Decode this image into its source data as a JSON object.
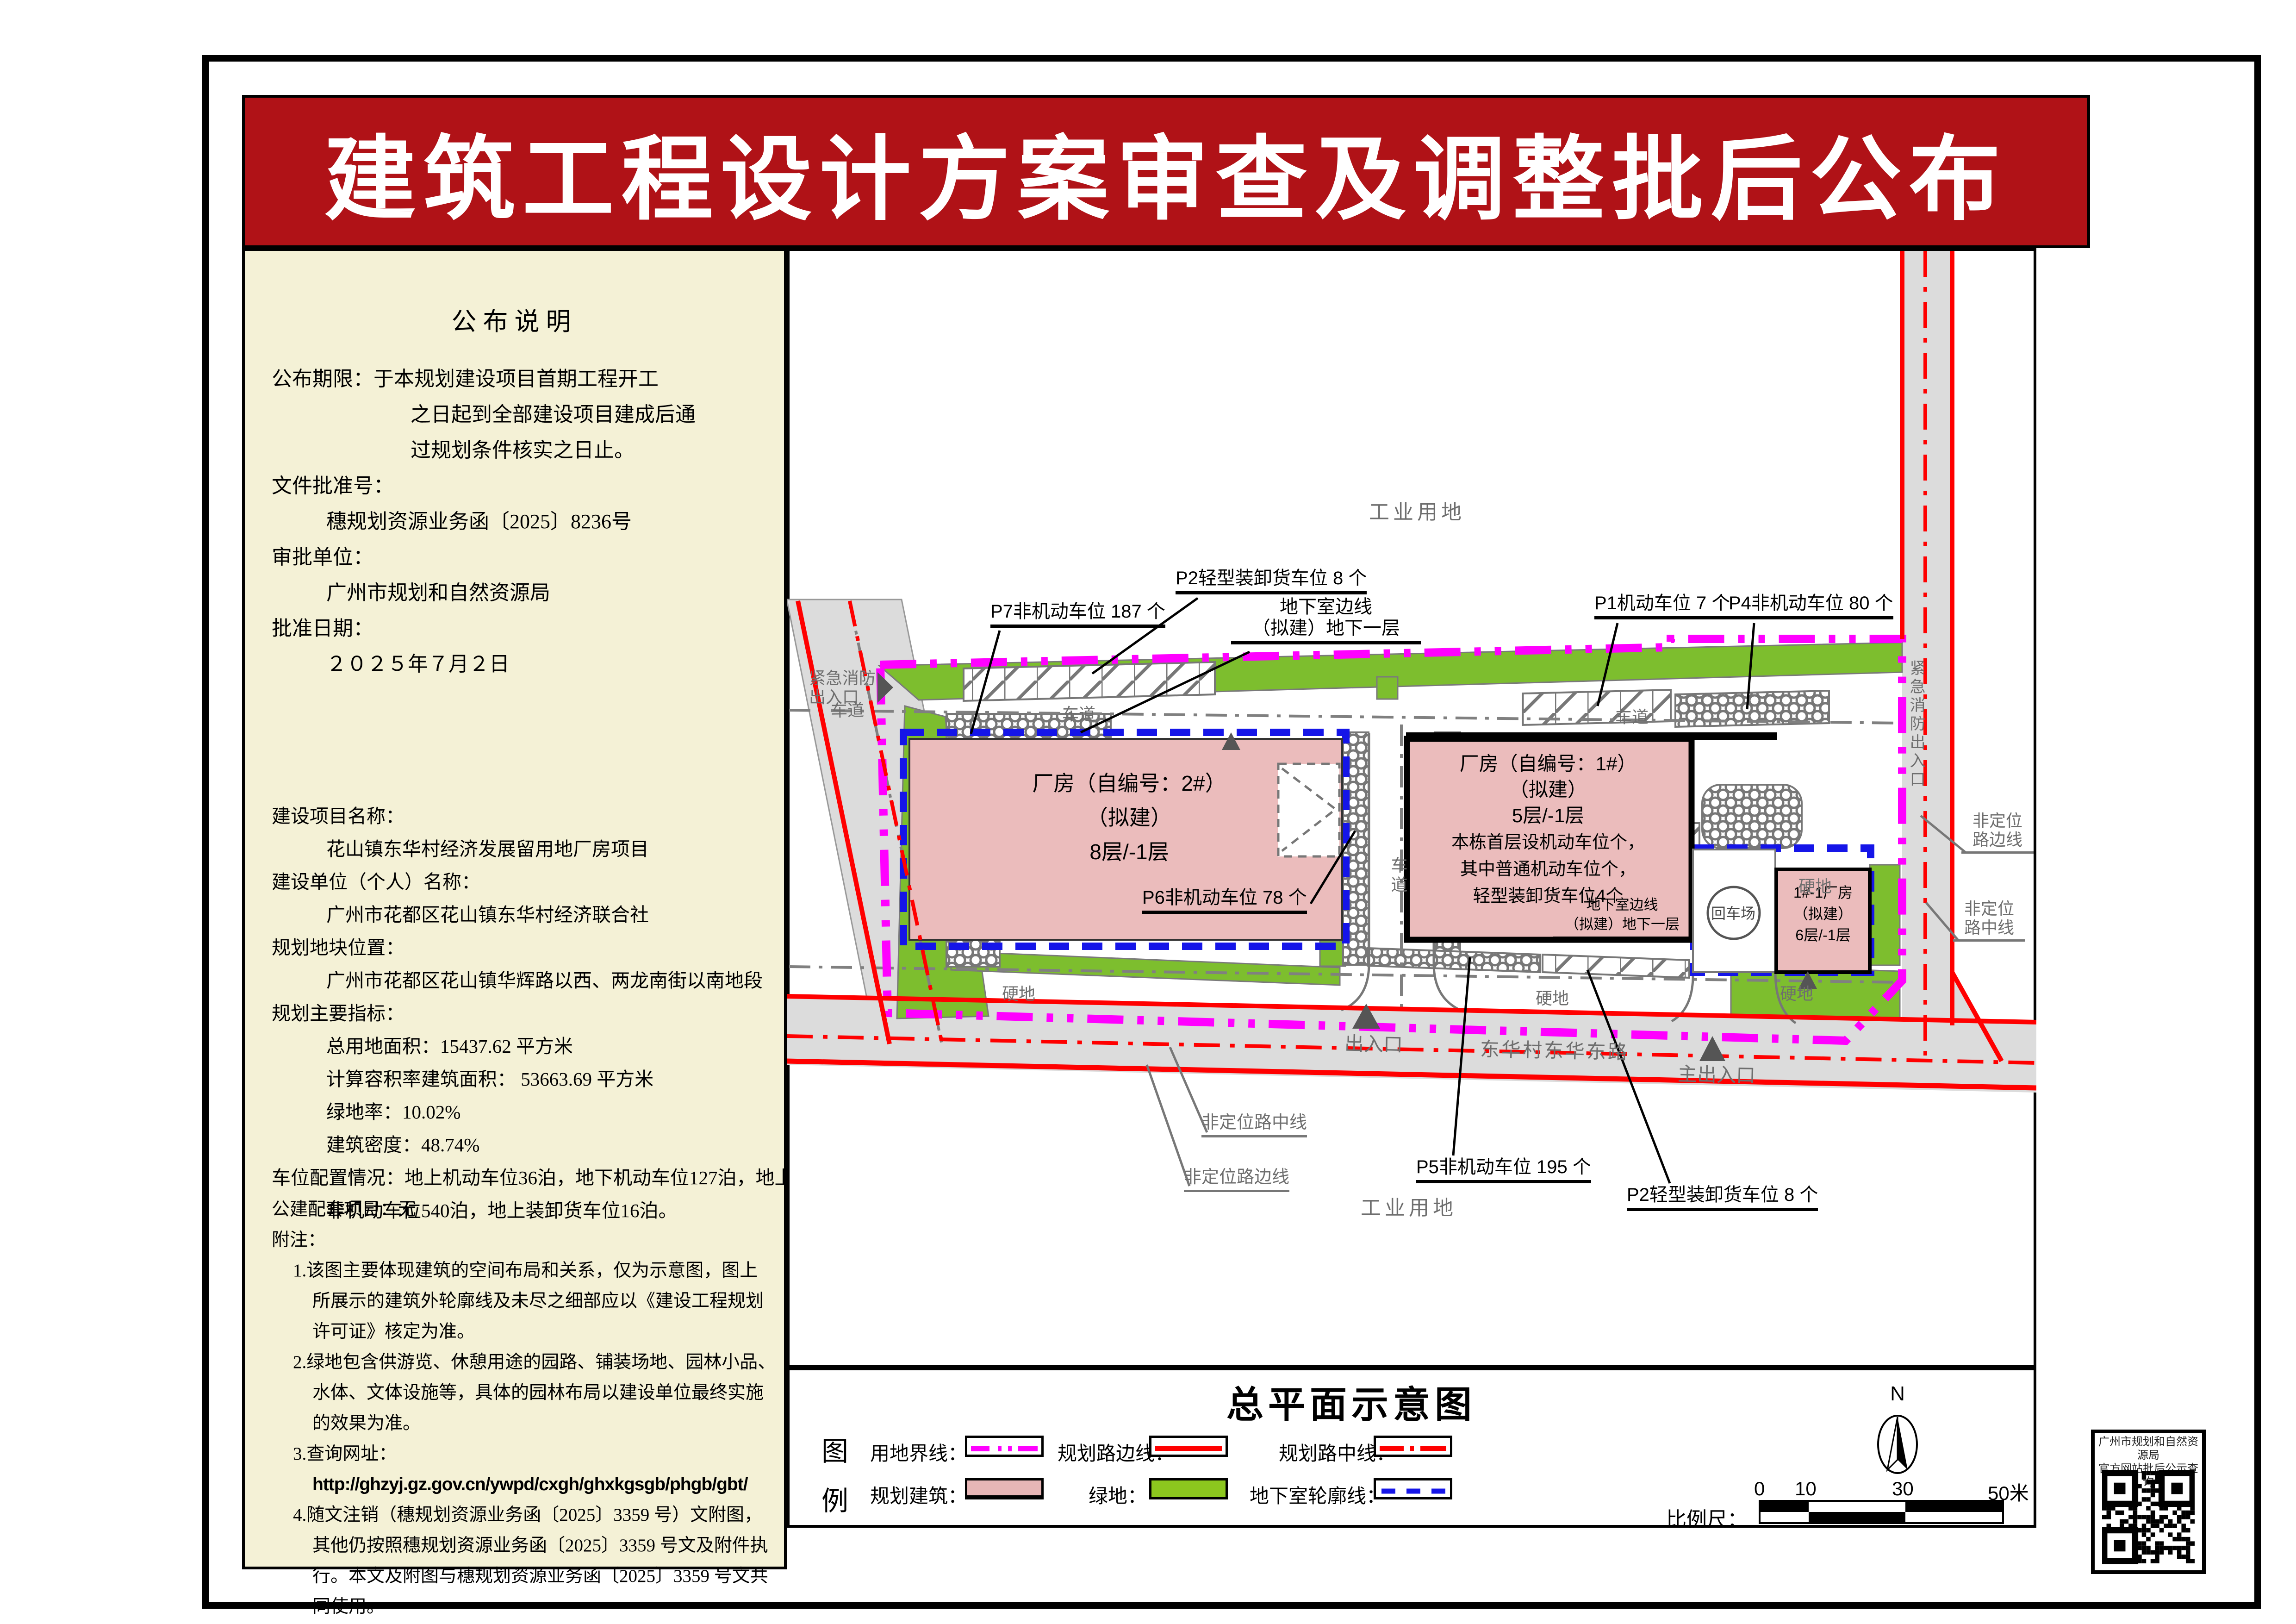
{
  "banner": {
    "title": "建筑工程设计方案审查及调整批后公布"
  },
  "panel": {
    "title": "公布说明",
    "secA": [
      {
        "t": "公布期限：于本规划建设项目首期工程开工",
        "c": "i0"
      },
      {
        "t": "之日起到全部建设项目建成后通",
        "c": "i2"
      },
      {
        "t": "过规划条件核实之日止。",
        "c": "i2"
      },
      {
        "t": "文件批准号：",
        "c": "i0"
      },
      {
        "t": "穗规划资源业务函〔2025〕8236号",
        "c": "i1"
      },
      {
        "t": "审批单位：",
        "c": "i0"
      },
      {
        "t": "广州市规划和自然资源局",
        "c": "i1"
      },
      {
        "t": "批准日期：",
        "c": "i0"
      },
      {
        "t": "２０２５年７月２日",
        "c": "i1"
      }
    ],
    "secB": [
      {
        "t": "建设项目名称：",
        "c": "i0"
      },
      {
        "t": "花山镇东华村经济发展留用地厂房项目",
        "c": "i1"
      },
      {
        "t": "建设单位（个人）名称：",
        "c": "i0"
      },
      {
        "t": "广州市花都区花山镇东华村经济联合社",
        "c": "i1"
      },
      {
        "t": "规划地块位置：",
        "c": "i0"
      },
      {
        "t": "广州市花都区花山镇华辉路以西、两龙南街以南地段",
        "c": "i1"
      },
      {
        "t": "规划主要指标：",
        "c": "i0"
      },
      {
        "t": "总用地面积：15437.62 平方米",
        "c": "i1"
      },
      {
        "t": "计算容积率建筑面积： 53663.69 平方米",
        "c": "i1"
      },
      {
        "t": "绿地率：10.02%",
        "c": "i1"
      },
      {
        "t": "建筑密度：48.74%",
        "c": "i1"
      },
      {
        "t": "车位配置情况：地上机动车位36泊，地下机动车位127泊，地上",
        "c": "i0"
      },
      {
        "t": "非机动车位540泊，地上装卸货车位16泊。",
        "c": "i1"
      }
    ],
    "secC": [
      {
        "t": "公建配套项目：无",
        "c": "i0"
      },
      {
        "t": "附注：",
        "c": "i0"
      },
      {
        "t": "1.该图主要体现建筑的空间布局和关系，仅为示意图，图上",
        "c": "n1"
      },
      {
        "t": "所展示的建筑外轮廓线及未尽之细部应以《建设工程规划",
        "c": "n2"
      },
      {
        "t": "许可证》核定为准。",
        "c": "n2"
      },
      {
        "t": "2.绿地包含供游览、休憩用途的园路、铺装场地、园林小品、",
        "c": "n1"
      },
      {
        "t": "水体、文体设施等，具体的园林布局以建设单位最终实施",
        "c": "n2"
      },
      {
        "t": "的效果为准。",
        "c": "n2"
      },
      {
        "t": "3.查询网址：",
        "c": "n1"
      },
      {
        "t": "http://ghzyj.gz.gov.cn/ywpd/cxgh/ghxkgsgb/phgb/gbt/",
        "c": "n2 url"
      },
      {
        "t": "4.随文注销（穗规划资源业务函〔2025〕3359 号）文附图，",
        "c": "n1"
      },
      {
        "t": "其他仍按照穗规划资源业务函〔2025〕3359 号文及附件执",
        "c": "n2"
      },
      {
        "t": "行。本文及附图与穗规划资源业务函〔2025〕3359 号文共",
        "c": "n2"
      },
      {
        "t": "同使用。",
        "c": "n2"
      }
    ]
  },
  "map": {
    "labels": {
      "industrial": "工业用地",
      "p7": "P7非机动车位 187 个",
      "p2_top": "P2轻型装卸货车位 8 个",
      "basement_l1": "地下室边线",
      "basement_l2": "（拟建）地下一层",
      "p1": "P1机动车位 7 个",
      "p4": "P4非机动车位 80 个",
      "fire_l1": "紧急消防",
      "fire_l2": "出入口",
      "fire_vertical": "紧急消防出入口",
      "lane": "车道",
      "bld2_l1": "厂房（自编号：2#）",
      "bld2_l2": "（拟建）",
      "bld2_l3": "8层/-1层",
      "p6": "P6非机动车位 78 个",
      "bld1_l1": "厂房（自编号：1#）",
      "bld1_l2": "（拟建）",
      "bld1_l3": "5层/-1层",
      "bld1_l4": "本栋首层设机动车位个，",
      "bld1_l5": "其中普通机动车位个，",
      "bld1_l6": "轻型装卸货车位4个",
      "bld3_l1": "1#-1厂房",
      "bld3_l2": "（拟建）",
      "bld3_l3": "6层/-1层",
      "turnaround": "回车场",
      "hard": "硬地",
      "exit": "出入口",
      "road_name": "东华村东华东路",
      "main_exit": "主出入口",
      "p5": "P5非机动车位 195 个",
      "p2_bottom": "P2轻型装卸货车位 8 个",
      "nonloc_center": "非定位路中线",
      "nonloc_edge": "非定位路边线",
      "nonloc_l1": "非定位",
      "nonloc_edge_l2": "路边线",
      "nonloc_center_l2": "路中线"
    }
  },
  "legend": {
    "title": "总平面示意图",
    "char1": "图",
    "char2": "例",
    "items": {
      "boundary": "用地界线：",
      "road_edge": "规划路边线：",
      "road_center": "规划路中线：",
      "building": "规划建筑：",
      "green": "绿地：",
      "underground": "地下室轮廓线："
    }
  },
  "scalebar": {
    "label": "比例尺：",
    "ticks": [
      "0",
      "10",
      "30",
      "50米"
    ]
  },
  "north": {
    "label": "N"
  },
  "qr": {
    "line1": "广州市规划和自然资源局",
    "line2": "官方网站批后公示查询"
  },
  "colors": {
    "banner_red": "#B01217",
    "panel_cream": "#F4F1D6",
    "boundary_magenta": "#FF00FF",
    "planning_red": "#FF0000",
    "building_pink": "#EBBCBC",
    "green": "#7DBE2E",
    "underground_blue": "#1515E8",
    "road_gray": "#DCDCDC"
  }
}
